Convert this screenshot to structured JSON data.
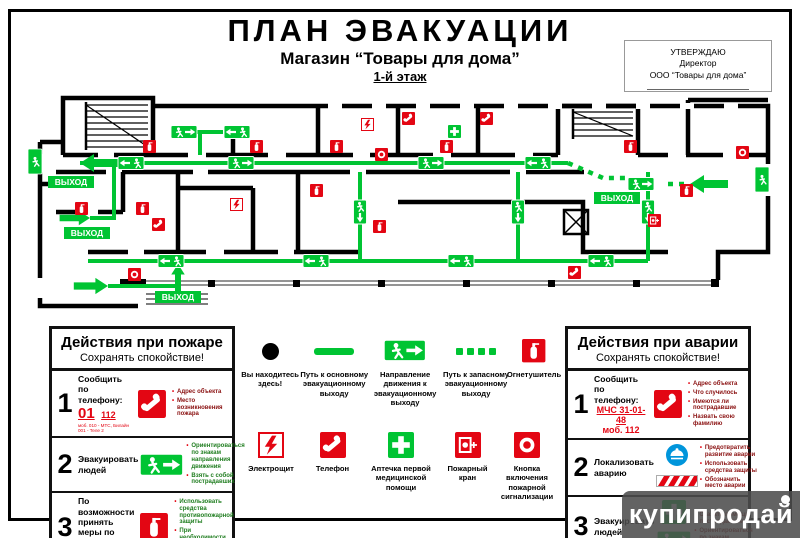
{
  "colors": {
    "green": "#00c433",
    "red": "#e30613",
    "blue": "#0095db",
    "wall": "#000000",
    "dark_red": "#8a1010",
    "dark_green": "#1f7d1f"
  },
  "header": {
    "title": "ПЛАН  ЭВАКУАЦИИ",
    "subtitle": "Магазин “Товары для дома”",
    "floor": "1-й этаж"
  },
  "approval": {
    "line1": "УТВЕРЖДАЮ",
    "line2": "Директор",
    "line3": "ООО “Товары для дома”"
  },
  "plan": {
    "exit_label": "ВЫХОД"
  },
  "legend": {
    "row1": [
      "Вы находитесь здесь!",
      "Путь к основному эвакуационному выходу",
      "Направление движения к эвакуационному выходу",
      "Путь к запасному эвакуационному выходу",
      "Огнетушитель"
    ],
    "row2": [
      "Электрощит",
      "Телефон",
      "Аптечка первой медицинской помощи",
      "Пожарный кран",
      "Кнопка включения пожарной сигнализации"
    ]
  },
  "fire_box": {
    "title": "Действия при пожаре",
    "subtitle": "Сохранять спокойствие!",
    "steps": [
      {
        "num": "1",
        "action": "Сообщить по телефону:",
        "phone_big": "01",
        "phone_small": "112",
        "phone_note": "моб. 010 - МТС, Билайн 001 - Теле 2",
        "bullets": [
          "Адрес объекта",
          "Место возникновения пожара"
        ]
      },
      {
        "num": "2",
        "action": "Эвакуировать людей",
        "bullets": [
          "Ориентироваться по знакам направления движения",
          "Взять с собой пострадавших"
        ]
      },
      {
        "num": "3",
        "action": "По возможности принять меры по тушению пожара",
        "bullets": [
          "Использовать средства противопожарной защиты",
          "При необходимости обесточить помещение"
        ]
      }
    ]
  },
  "accident_box": {
    "title": "Действия при аварии",
    "subtitle": "Сохранять спокойствие!",
    "steps": [
      {
        "num": "1",
        "action": "Сообщить по телефону:",
        "phone_line1": "МЧС 31-01-48",
        "phone_line2": "моб. 112",
        "bullets": [
          "Адрес объекта",
          "Что случилось",
          "Имеются ли пострадавшие",
          "Назвать свою фамилию"
        ]
      },
      {
        "num": "2",
        "action": "Локализовать аварию",
        "bullets": [
          "Предотвратить развитие аварии",
          "Использовать средства защиты",
          "Обозначить место аварии"
        ]
      },
      {
        "num": "3",
        "action": "Эвакуировать людей",
        "bullets": [
          "Оказать помощь пострадавшим",
          "Ориентироваться по знакам"
        ]
      }
    ]
  },
  "watermark": {
    "text": "купипродай"
  }
}
